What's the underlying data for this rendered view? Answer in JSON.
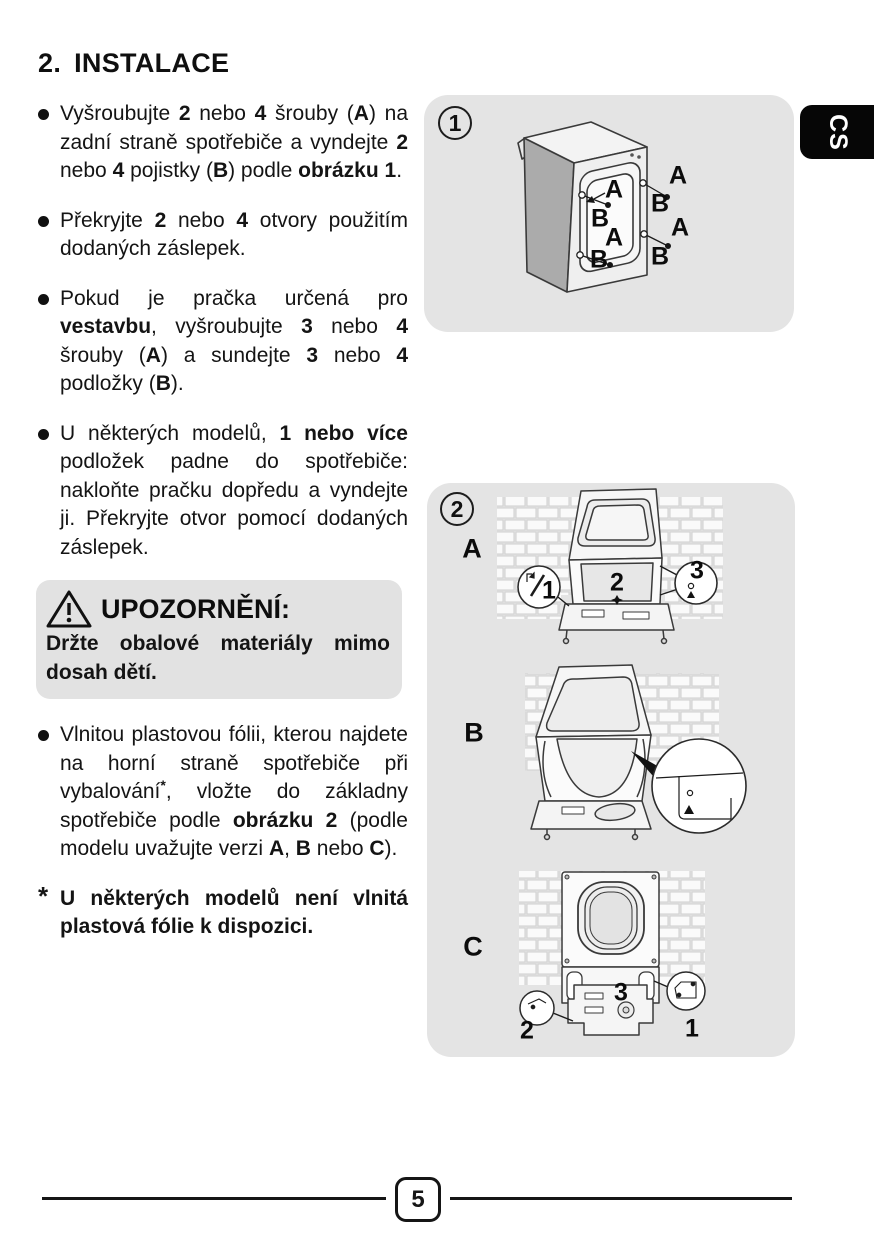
{
  "page": {
    "language_tab": "CS",
    "page_number": "5"
  },
  "colors": {
    "figure_bg": "#e4e4e4",
    "warning_bg": "#e2e2e2",
    "tab_bg": "#060606",
    "text": "#141414"
  },
  "icons": {
    "warning": "warning-triangle-icon",
    "bullet": "bullet-dot-icon"
  },
  "section": {
    "title_number": "2.",
    "title_text": "INSTALACE"
  },
  "bullets": [
    {
      "segs": [
        "Vyšroubujte ",
        "2",
        " nebo ",
        "4",
        " šrouby (",
        "A",
        ") na zadní straně spotřebiče a vyndejte ",
        "2",
        " nebo ",
        "4",
        " pojistky (",
        "B",
        ") podle ",
        "obrázku 1",
        "."
      ]
    },
    {
      "segs": [
        "Překryjte ",
        "2",
        " nebo ",
        "4",
        " otvory použitím dodaných záslepek."
      ]
    },
    {
      "segs": [
        "Pokud je pračka určená pro ",
        "vestavbu",
        ", vyšroubujte ",
        "3",
        " nebo ",
        "4",
        " šrouby (",
        "A",
        ") a sundejte ",
        "3",
        " nebo ",
        "4",
        " podložky (",
        "B",
        ")."
      ]
    },
    {
      "segs": [
        "U některých modelů, ",
        "1 nebo více",
        " podložek padne do spotřebiče: nakloňte pračku dopředu a vyndejte ji. Překryjte otvor pomocí dodaných záslepek."
      ]
    },
    {
      "segs": [
        "Vlnitou plastovou fólii, kterou najdete na horní straně spotřebiče při vybalování",
        "*",
        ", vložte do základny spotřebiče podle ",
        "obrázku 2",
        " (podle modelu uvažujte verzi ",
        "A",
        ", ",
        "B",
        " nebo ",
        "C",
        ")."
      ]
    }
  ],
  "warning": {
    "title": "UPOZORNĚNÍ:",
    "body": "Držte obalové materiály mimo dosah dětí."
  },
  "footnote": {
    "marker": "*",
    "text": "U některých modelů není vlnitá plastová fólie k dispozici."
  },
  "figure1": {
    "number": "1",
    "label_a": "A",
    "label_b": "B"
  },
  "figure2": {
    "number": "2",
    "section_a": "A",
    "section_b": "B",
    "section_c": "C",
    "n1": "1",
    "n2": "2",
    "n3": "3"
  }
}
